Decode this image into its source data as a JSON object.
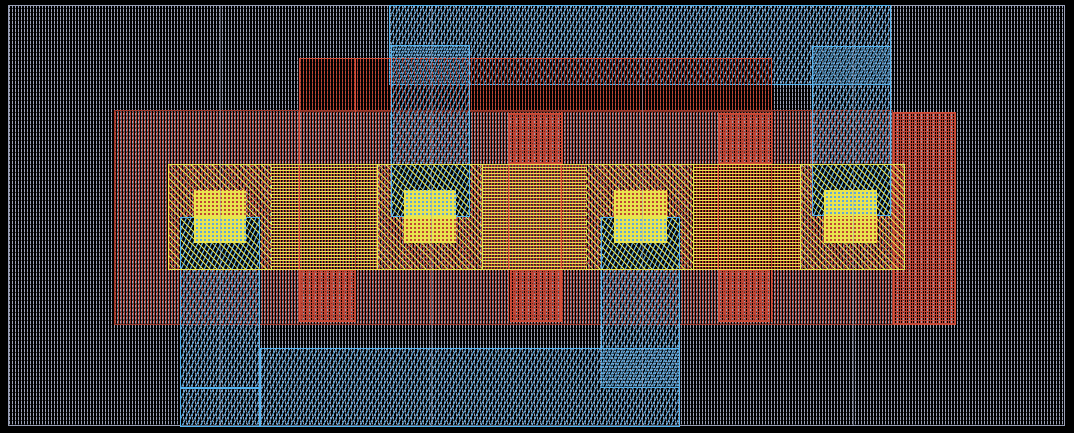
{
  "window": {
    "width": 1074,
    "height": 433,
    "background": "#000000"
  },
  "colors": {
    "background": "#000000",
    "well_gray": "#9aa0b6",
    "metal_blue": "#5fa8dc",
    "metal_blue_bright": "#55b4f0",
    "poly_red": "#c04535",
    "poly_red_bright": "#d24e38",
    "poly_red_dim": "#a03a2c",
    "diff_yellow": "#e9e44e"
  },
  "layers": [
    {
      "name": "well-substrate-region",
      "pattern": "pat-substrate",
      "x": 8,
      "y": 5,
      "w": 1057,
      "h": 421,
      "border": "well_gray"
    },
    {
      "name": "metal-rect-top",
      "pattern": "pat-blue",
      "x": 389,
      "y": 5,
      "w": 502,
      "h": 80,
      "border": "metal_blue_bright"
    },
    {
      "name": "poly-rect-upper",
      "pattern": "pat-red",
      "x": 299,
      "y": 58,
      "w": 473,
      "h": 54,
      "border": "poly_red_bright"
    },
    {
      "name": "implant-rect-main",
      "pattern": "pat-red",
      "x": 114,
      "y": 110,
      "w": 779,
      "h": 215,
      "border": "poly_red_dim"
    },
    {
      "name": "implant-rect-right",
      "pattern": "pat-red-dense",
      "x": 893,
      "y": 112,
      "w": 63,
      "h": 213,
      "border": "poly_red_bright"
    },
    {
      "name": "metal-box-contact2",
      "pattern": "pat-blue",
      "x": 391,
      "y": 45,
      "w": 79,
      "h": 172,
      "border": "metal_blue_bright"
    },
    {
      "name": "metal-box-contact4",
      "pattern": "pat-blue",
      "x": 812,
      "y": 46,
      "w": 79,
      "h": 170,
      "border": "metal_blue_bright"
    },
    {
      "name": "metal-column-contact1",
      "pattern": "pat-blue",
      "x": 180,
      "y": 217,
      "w": 80,
      "h": 210,
      "border": "metal_blue_bright"
    },
    {
      "name": "metal-column-contact3",
      "pattern": "pat-blue",
      "x": 601,
      "y": 217,
      "w": 79,
      "h": 171,
      "border": "metal_blue_bright"
    },
    {
      "name": "metal-rect-bottom",
      "pattern": "pat-blue",
      "x": 260,
      "y": 348,
      "w": 420,
      "h": 79,
      "border": "metal_blue_bright"
    },
    {
      "name": "metal-segment-line",
      "pattern": "solid-blue",
      "x": 180,
      "y": 387,
      "w": 80,
      "h": 2
    },
    {
      "name": "active-contact-section-1",
      "pattern": "pat-band-contact",
      "x": 168,
      "y": 164,
      "w": 103,
      "h": 106
    },
    {
      "name": "active-gate-section-1",
      "pattern": "pat-band-gate",
      "x": 271,
      "y": 164,
      "w": 106,
      "h": 106
    },
    {
      "name": "active-contact-section-2",
      "pattern": "pat-band-contact",
      "x": 377,
      "y": 164,
      "w": 105,
      "h": 106
    },
    {
      "name": "active-gate-section-2",
      "pattern": "pat-band-gate",
      "x": 482,
      "y": 164,
      "w": 104,
      "h": 106
    },
    {
      "name": "active-contact-section-3",
      "pattern": "pat-band-contact",
      "x": 586,
      "y": 164,
      "w": 107,
      "h": 106
    },
    {
      "name": "active-gate-section-3",
      "pattern": "pat-band-gate",
      "x": 693,
      "y": 164,
      "w": 107,
      "h": 106
    },
    {
      "name": "active-contact-section-4",
      "pattern": "pat-band-contact",
      "x": 800,
      "y": 164,
      "w": 105,
      "h": 106
    },
    {
      "name": "metal-over-active-1",
      "pattern": "pat-blue-yellow",
      "x": 180,
      "y": 217,
      "w": 80,
      "h": 53,
      "border": "metal_blue_bright"
    },
    {
      "name": "metal-over-active-2",
      "pattern": "pat-blue-yellow",
      "x": 391,
      "y": 164,
      "w": 79,
      "h": 53,
      "border": "metal_blue_bright"
    },
    {
      "name": "metal-over-active-3",
      "pattern": "pat-blue-yellow",
      "x": 601,
      "y": 217,
      "w": 79,
      "h": 53,
      "border": "metal_blue_bright"
    },
    {
      "name": "metal-over-active-4",
      "pattern": "pat-blue-yellow",
      "x": 812,
      "y": 164,
      "w": 79,
      "h": 52,
      "border": "metal_blue_bright"
    },
    {
      "name": "poly-pad-top-gate2",
      "pattern": "pat-red-dense",
      "x": 508,
      "y": 113,
      "w": 55,
      "h": 51,
      "border": "poly_red_bright"
    },
    {
      "name": "poly-pad-top-gate3",
      "pattern": "pat-red-dense",
      "x": 718,
      "y": 113,
      "w": 54,
      "h": 51,
      "border": "poly_red_bright"
    },
    {
      "name": "poly-pad-bottom-gate1",
      "pattern": "pat-red-dense",
      "x": 299,
      "y": 270,
      "w": 57,
      "h": 52,
      "border": "poly_red_bright"
    },
    {
      "name": "poly-pad-bottom-gate2",
      "pattern": "pat-red-dense",
      "x": 510,
      "y": 270,
      "w": 51,
      "h": 52,
      "border": "poly_red_bright"
    },
    {
      "name": "poly-pad-bottom-gate3",
      "pattern": "pat-red-dense",
      "x": 718,
      "y": 270,
      "w": 52,
      "h": 52,
      "border": "poly_red_bright"
    },
    {
      "name": "poly-gate-strip-1",
      "pattern": "gate-strip",
      "x": 299,
      "y": 58,
      "w": 57,
      "h": 264
    },
    {
      "name": "poly-gate-strip-2",
      "pattern": "gate-strip",
      "x": 508,
      "y": 112,
      "w": 54,
      "h": 210
    },
    {
      "name": "poly-gate-strip-3",
      "pattern": "gate-strip",
      "x": 718,
      "y": 112,
      "w": 54,
      "h": 210
    },
    {
      "name": "contact-1-top",
      "pattern": "sq-red",
      "x": 194,
      "y": 190,
      "w": 52,
      "h": 27
    },
    {
      "name": "contact-1-bottom",
      "pattern": "sq-blue",
      "x": 194,
      "y": 217,
      "w": 52,
      "h": 26
    },
    {
      "name": "contact-2-top",
      "pattern": "sq-blue",
      "x": 404,
      "y": 190,
      "w": 52,
      "h": 27
    },
    {
      "name": "contact-2-bottom",
      "pattern": "sq-red",
      "x": 404,
      "y": 217,
      "w": 52,
      "h": 26
    },
    {
      "name": "contact-3-top",
      "pattern": "sq-red",
      "x": 614,
      "y": 190,
      "w": 53,
      "h": 27
    },
    {
      "name": "contact-3-bottom",
      "pattern": "sq-blue",
      "x": 614,
      "y": 217,
      "w": 53,
      "h": 26
    },
    {
      "name": "contact-4-top",
      "pattern": "sq-blue",
      "x": 824,
      "y": 190,
      "w": 53,
      "h": 26
    },
    {
      "name": "contact-4-bottom",
      "pattern": "sq-red",
      "x": 824,
      "y": 216,
      "w": 53,
      "h": 27
    },
    {
      "name": "active-band-outline",
      "pattern": "outline-yellow",
      "x": 168,
      "y": 164,
      "w": 737,
      "h": 106
    },
    {
      "name": "active-divider-1",
      "pattern": "y-dashed",
      "x": 271,
      "y": 164,
      "w": 1,
      "h": 106
    },
    {
      "name": "active-divider-2",
      "pattern": "y-solid",
      "x": 377,
      "y": 164,
      "w": 1,
      "h": 106
    },
    {
      "name": "active-divider-3",
      "pattern": "y-solid",
      "x": 482,
      "y": 164,
      "w": 1,
      "h": 106
    },
    {
      "name": "active-divider-4",
      "pattern": "y-dashed",
      "x": 586,
      "y": 164,
      "w": 1,
      "h": 106
    },
    {
      "name": "active-divider-5",
      "pattern": "y-solid",
      "x": 693,
      "y": 164,
      "w": 1,
      "h": 106
    },
    {
      "name": "active-divider-6",
      "pattern": "y-solid",
      "x": 800,
      "y": 164,
      "w": 1,
      "h": 106
    },
    {
      "name": "cell-boundary-seam-1",
      "pattern": "seam",
      "x": 220,
      "y": 5,
      "w": 1,
      "h": 421
    },
    {
      "name": "cell-boundary-seam-2",
      "pattern": "seam",
      "x": 431,
      "y": 5,
      "w": 1,
      "h": 421
    },
    {
      "name": "cell-boundary-seam-3",
      "pattern": "seam",
      "x": 642,
      "y": 5,
      "w": 1,
      "h": 421
    },
    {
      "name": "cell-boundary-seam-4",
      "pattern": "seam",
      "x": 853,
      "y": 5,
      "w": 1,
      "h": 421
    }
  ]
}
